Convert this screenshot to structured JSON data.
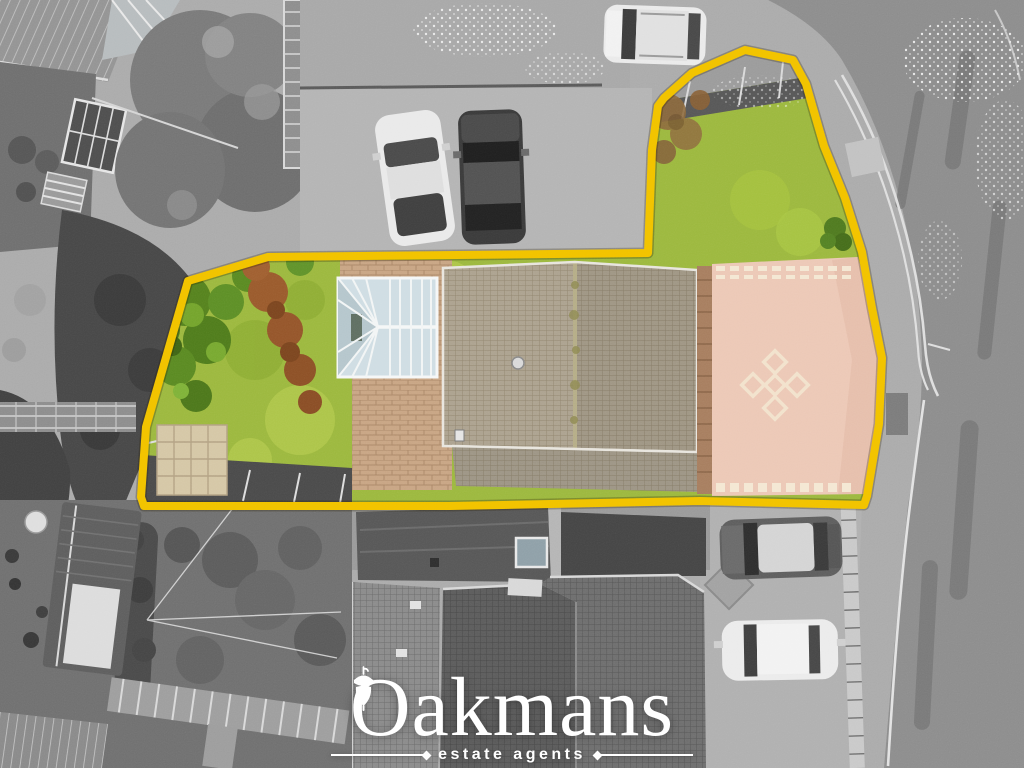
{
  "image": {
    "kind": "aerial-drone-photograph",
    "style": "surroundings greyscale, marketed plot shown in colour",
    "width_px": 1024,
    "height_px": 768
  },
  "watermark": {
    "brand": "Oakmans",
    "tagline": "estate agents",
    "icon": "acorn-icon",
    "color": "#FFFFFF"
  },
  "plot_boundary": {
    "color": "#F2C200",
    "stroke_width_px": 8,
    "points": "745,50 793,60 806,84 824,146 845,198 862,252 872,308 882,358 879,424 867,496 864,505 700,501 450,506 144,506 141,497 146,427 188,281 268,257 648,253 652,150 658,106 664,98 692,73"
  },
  "plot_features": {
    "lawn": "#9CB83E",
    "bushes": "#55821E",
    "dead_hedge": "#9A5A2C",
    "conservatory_glass": "#CFDDE3",
    "house_roof": "#ACA28F",
    "block_paved_driveway": "#ECC8B6",
    "driveway_motif": "#F2E2CC",
    "patio_slabs": "#D5C7A6",
    "tarmac": "#4A4A4A"
  },
  "surroundings": {
    "tone": "greyscale",
    "elements": [
      "neighbour gardens with trees and greenhouse",
      "parking forecourt with white car and dark car",
      "white SUV parked at top",
      "curved road with double white lines",
      "two parked cars lower right",
      "neighbouring house roofs",
      "garden shed, pergola and washing lines"
    ]
  }
}
